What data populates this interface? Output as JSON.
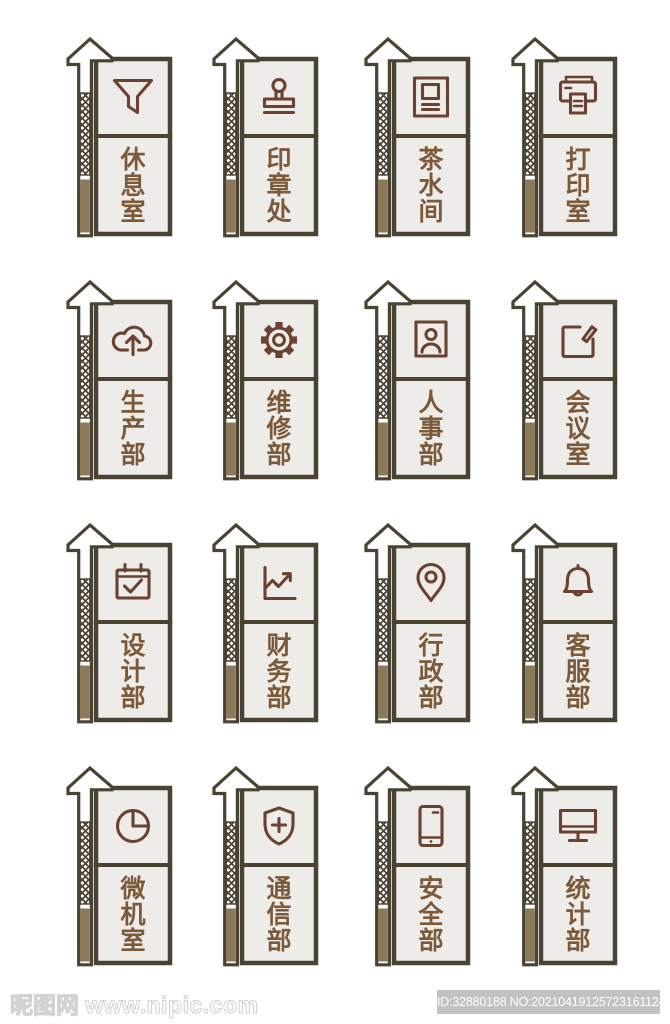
{
  "page": {
    "kind": "door-sign design set preview",
    "background": "#ffffff",
    "grid": "4x4 house-shaped room signs"
  },
  "palette": {
    "outline": "#4A4232",
    "panel_fill": "#EDECE9",
    "icon_stroke": "#6B4231",
    "label_text": "#7B5939",
    "strip_brown": "#8C7957",
    "badge_bg": "#C2C2C2",
    "badge_text": "#FFFFFF"
  },
  "signs": [
    {
      "label": "休息室",
      "icon": "funnel-icon"
    },
    {
      "label": "印章处",
      "icon": "stamp-icon"
    },
    {
      "label": "茶水间",
      "icon": "document-icon"
    },
    {
      "label": "打印室",
      "icon": "printer-icon"
    },
    {
      "label": "生产部",
      "icon": "cloud-upload-icon"
    },
    {
      "label": "维修部",
      "icon": "gear-icon"
    },
    {
      "label": "人事部",
      "icon": "user-card-icon"
    },
    {
      "label": "会议室",
      "icon": "edit-icon"
    },
    {
      "label": "设计部",
      "icon": "calendar-check-icon"
    },
    {
      "label": "财务部",
      "icon": "line-chart-icon"
    },
    {
      "label": "行政部",
      "icon": "location-pin-icon"
    },
    {
      "label": "客服部",
      "icon": "bell-icon"
    },
    {
      "label": "微机室",
      "icon": "pie-chart-icon"
    },
    {
      "label": "通信部",
      "icon": "shield-plus-icon"
    },
    {
      "label": "安全部",
      "icon": "smartphone-icon"
    },
    {
      "label": "统计部",
      "icon": "monitor-icon"
    }
  ],
  "watermark": {
    "site_name": "昵图网",
    "site_url": "www.nipic.com",
    "id_label": "ID:32880188 NO:20210419125723161124"
  }
}
